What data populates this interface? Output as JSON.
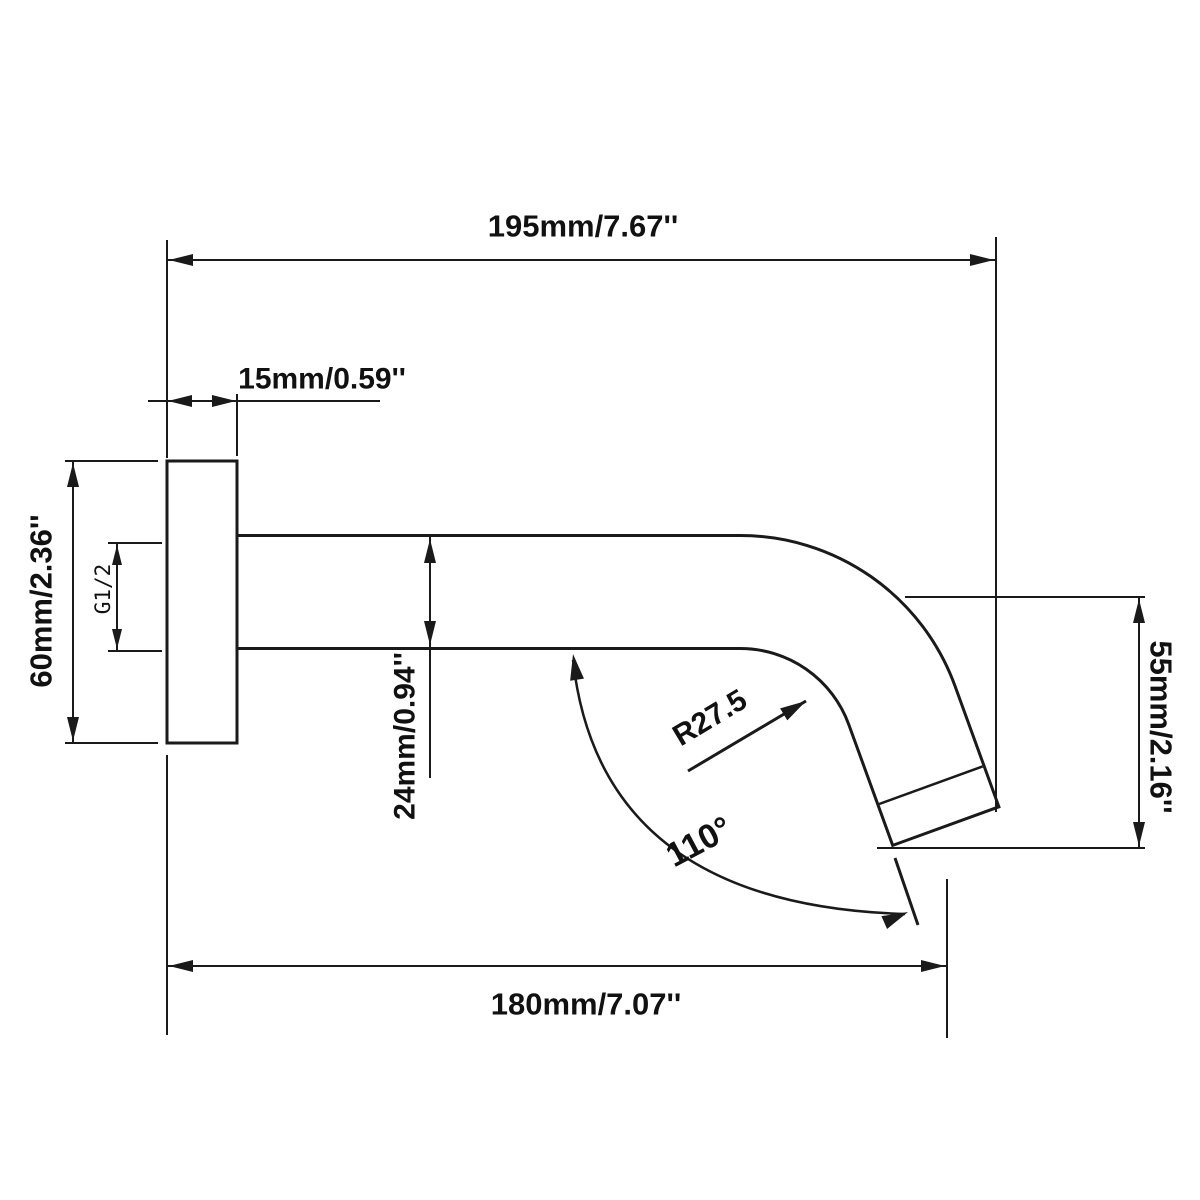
{
  "drawing": {
    "ink_color": "#1a1a1a",
    "background_color": "#ffffff",
    "labels": {
      "overall_length": "195mm/7.67''",
      "flange_depth": "15mm/0.59''",
      "flange_height": "60mm/2.36''",
      "thread_size": "G1/2",
      "pipe_diameter": "24mm/0.94''",
      "bend_radius": "R27.5",
      "bend_angle": "110°",
      "drop_height": "55mm/2.16''",
      "projection_length": "180mm/7.07''"
    }
  }
}
